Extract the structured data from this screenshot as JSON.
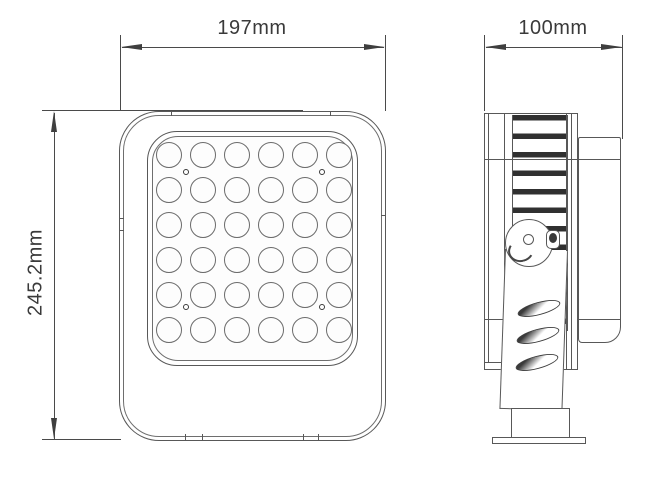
{
  "drawing": {
    "title": "floodlight-dimension-drawing",
    "dimensions": {
      "width_label": "197mm",
      "depth_label": "100mm",
      "height_label": "245.2mm"
    },
    "front_view": {
      "led_rows": 6,
      "led_cols": 6,
      "screw_dot_count": 4
    },
    "side_view": {
      "bracket_slot_count": 3
    },
    "colors": {
      "line": "#585858",
      "dimension_line": "#4a4a4a",
      "fin_dark": "#303030",
      "background": "#ffffff"
    }
  }
}
